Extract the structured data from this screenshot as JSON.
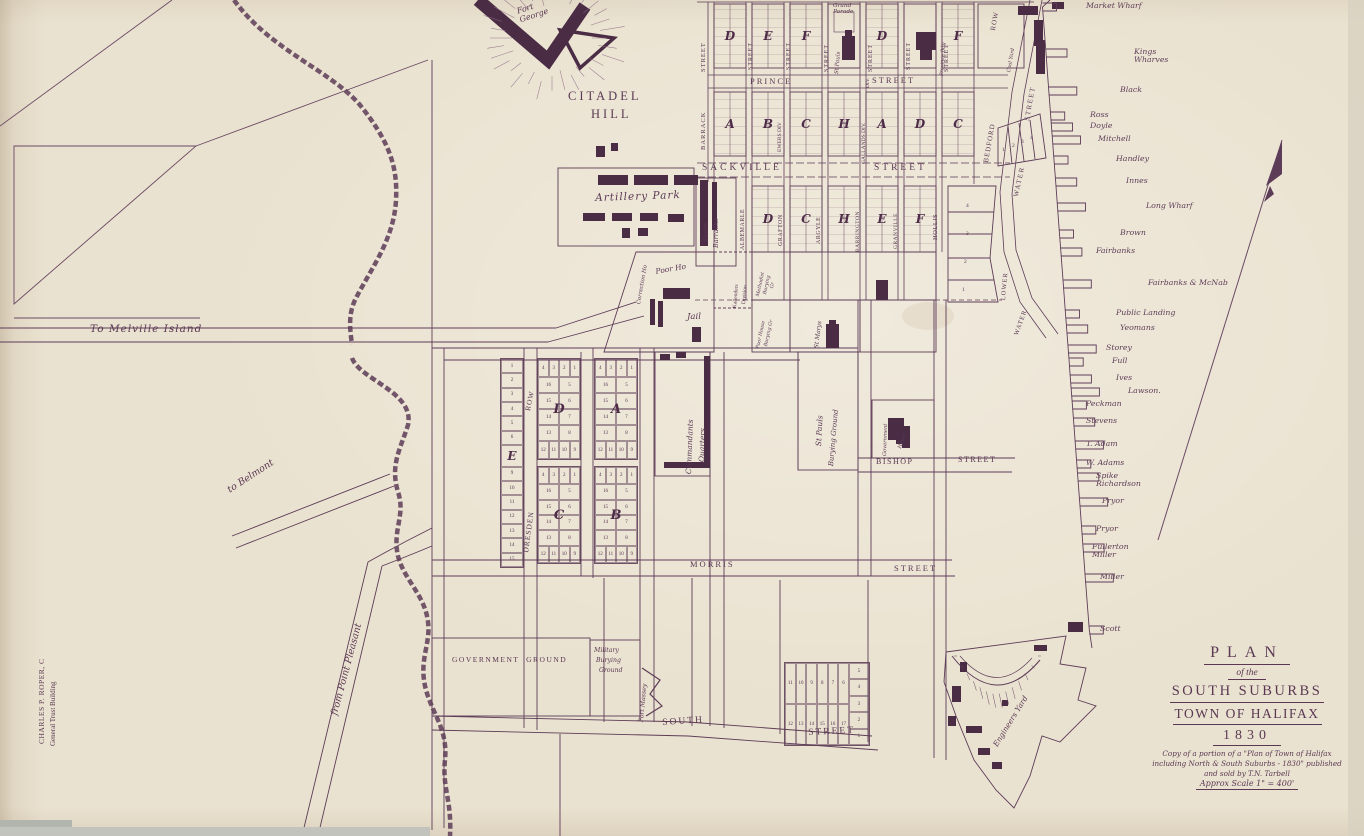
{
  "map_title": "Plan of the South Suburbs Town of Halifax 1830",
  "ink_color": "#5a3853",
  "paper_color": "#eae2d0",
  "dark_building_color": "#4a2c45",
  "title_block": {
    "plan": "PLAN",
    "of_the": "of the",
    "suburbs": "SOUTH SUBURBS",
    "town": "TOWN OF HALIFAX",
    "year": "1830",
    "note1": "Copy of a portion of a \"Plan of Town of Halifax",
    "note2": "including North & South Suburbs - 1830\" published",
    "note3": "and sold by T.N. Tarbell",
    "scale": "Approx Scale 1\" = 400'"
  },
  "labels": [
    {
      "n": "fort-george",
      "t": "Fort\nGeorge",
      "x": 516,
      "y": 8,
      "r": -18,
      "s": 8,
      "c": "h"
    },
    {
      "n": "citadel",
      "t": "CITADEL",
      "x": 568,
      "y": 90,
      "s": 12.5,
      "ls": 3,
      "c": "c"
    },
    {
      "n": "citadel-hill",
      "t": "HILL",
      "x": 591,
      "y": 108,
      "s": 12.5,
      "ls": 3,
      "c": "c"
    },
    {
      "n": "to-melville-island",
      "t": "To Melville Island",
      "x": 90,
      "y": 324,
      "s": 10.5,
      "ls": 1,
      "c": "h"
    },
    {
      "n": "to-belmont",
      "t": "to Belmont",
      "x": 226,
      "y": 487,
      "r": -33,
      "s": 9.5,
      "c": "h"
    },
    {
      "n": "from-point-pleasant",
      "t": "from Point Pleasant",
      "x": 330,
      "y": 714,
      "r": -75,
      "s": 9.5,
      "c": "h"
    },
    {
      "n": "credit-line-1",
      "t": "CHARLES P. ROPER, C",
      "x": 38,
      "y": 744,
      "r": -90,
      "s": 7.5,
      "ls": 0.5,
      "c": "p"
    },
    {
      "n": "credit-line-2",
      "t": "General Trust Building",
      "x": 50,
      "y": 746,
      "r": -90,
      "s": 7,
      "c": "p"
    },
    {
      "n": "barrack-street-name",
      "t": "BARRACK",
      "x": 700,
      "y": 150,
      "r": -90,
      "s": 6.5,
      "ls": 1,
      "c": "p"
    },
    {
      "n": "barrack-street-word",
      "t": "STREET",
      "x": 700,
      "y": 72,
      "r": -90,
      "s": 6.5,
      "ls": 1,
      "c": "p"
    },
    {
      "n": "street-v-2",
      "t": "STREET",
      "x": 748,
      "y": 70,
      "r": -90,
      "s": 6,
      "ls": 1,
      "c": "p"
    },
    {
      "n": "street-v-3",
      "t": "STREET",
      "x": 786,
      "y": 70,
      "r": -90,
      "s": 6,
      "ls": 1,
      "c": "p"
    },
    {
      "n": "street-v-4",
      "t": "STREET",
      "x": 824,
      "y": 72,
      "r": -90,
      "s": 6,
      "ls": 1,
      "c": "p"
    },
    {
      "n": "street-v-5",
      "t": "STREET",
      "x": 868,
      "y": 72,
      "r": -90,
      "s": 6,
      "ls": 1,
      "c": "p"
    },
    {
      "n": "street-v-6",
      "t": "STREET",
      "x": 906,
      "y": 70,
      "r": -90,
      "s": 6,
      "ls": 1,
      "c": "p"
    },
    {
      "n": "street-v-7",
      "t": "STREET",
      "x": 944,
      "y": 72,
      "r": -90,
      "s": 6,
      "ls": 1,
      "c": "p"
    },
    {
      "n": "bedford-row-word",
      "t": "ROW",
      "x": 990,
      "y": 30,
      "r": -80,
      "s": 7,
      "ls": 1,
      "c": "p"
    },
    {
      "n": "bedford-row-name",
      "t": "BEDFORD",
      "x": 983,
      "y": 162,
      "r": -80,
      "s": 7,
      "ls": 1,
      "c": "p"
    },
    {
      "n": "prince-street-name",
      "t": "PRINCE",
      "x": 750,
      "y": 77,
      "s": 8.5,
      "ls": 2,
      "c": "c"
    },
    {
      "n": "prince-street-word",
      "t": "STREET",
      "x": 872,
      "y": 76,
      "s": 8.5,
      "ls": 2,
      "c": "c"
    },
    {
      "n": "ewers-div",
      "t": "EWERS DIV",
      "x": 778,
      "y": 152,
      "r": -90,
      "s": 5.5,
      "c": "p"
    },
    {
      "n": "gallands-div",
      "t": "GALLANDS DIV.",
      "x": 862,
      "y": 164,
      "r": -90,
      "s": 5.5,
      "c": "p"
    },
    {
      "n": "div-label",
      "t": "DIV.",
      "x": 866,
      "y": 88,
      "r": -90,
      "s": 5.5,
      "c": "p"
    },
    {
      "n": "grand-parade",
      "t": "Grand\nParade",
      "x": 833,
      "y": 3,
      "s": 5.8,
      "c": "h"
    },
    {
      "n": "st-pauls-church",
      "t": "St Pauls",
      "x": 835,
      "y": 74,
      "r": -85,
      "s": 5.5,
      "c": "h"
    },
    {
      "n": "province-building",
      "t": "Province Bdg",
      "x": 940,
      "y": 76,
      "r": -87,
      "s": 5,
      "c": "h"
    },
    {
      "n": "coal-yard",
      "t": "Coal Yard",
      "x": 1007,
      "y": 72,
      "r": -80,
      "s": 5,
      "c": "h"
    },
    {
      "n": "sackville-street-name",
      "t": "SACKVILLE",
      "x": 702,
      "y": 163,
      "s": 9.5,
      "ls": 3,
      "c": "c"
    },
    {
      "n": "sackville-street-word",
      "t": "STREET",
      "x": 874,
      "y": 163,
      "s": 9.5,
      "ls": 3,
      "c": "c"
    },
    {
      "n": "albemarle-street",
      "t": "ALBEMARLE",
      "x": 740,
      "y": 250,
      "r": -90,
      "s": 6,
      "ls": 0.5,
      "c": "p"
    },
    {
      "n": "grafton-street",
      "t": "GRAFTON",
      "x": 778,
      "y": 246,
      "r": -90,
      "s": 6,
      "ls": 0.5,
      "c": "p"
    },
    {
      "n": "argyle-street",
      "t": "ARGYLE",
      "x": 816,
      "y": 244,
      "r": -90,
      "s": 6,
      "ls": 0.5,
      "c": "p"
    },
    {
      "n": "barrington-street",
      "t": "BARRINGTON",
      "x": 856,
      "y": 252,
      "r": -90,
      "s": 5.5,
      "ls": 0.5,
      "c": "p"
    },
    {
      "n": "granville-street",
      "t": "GRANVILLE",
      "x": 894,
      "y": 249,
      "r": -90,
      "s": 5.5,
      "ls": 0.5,
      "c": "p"
    },
    {
      "n": "hollis-street",
      "t": "HOLLIS",
      "x": 932,
      "y": 240,
      "r": -90,
      "s": 6.5,
      "ls": 0.5,
      "c": "p"
    },
    {
      "n": "water-street-name",
      "t": "WATER",
      "x": 1013,
      "y": 196,
      "r": -78,
      "s": 7,
      "ls": 1.5,
      "c": "p"
    },
    {
      "n": "water-street-word",
      "t": "STREET",
      "x": 1024,
      "y": 120,
      "r": -80,
      "s": 7,
      "ls": 1.5,
      "c": "p"
    },
    {
      "n": "lower-water-1",
      "t": "LOWER",
      "x": 1000,
      "y": 300,
      "r": -85,
      "s": 6.5,
      "ls": 1,
      "c": "p"
    },
    {
      "n": "lower-water-2",
      "t": "WATER",
      "x": 1013,
      "y": 334,
      "r": -70,
      "s": 6.5,
      "ls": 1,
      "c": "p"
    },
    {
      "n": "south-barracks-1",
      "t": "South",
      "x": 703,
      "y": 242,
      "r": -90,
      "s": 6.5,
      "c": "h"
    },
    {
      "n": "south-barracks-2",
      "t": "Barracks",
      "x": 713,
      "y": 248,
      "r": -90,
      "s": 6.5,
      "c": "h"
    },
    {
      "n": "artillery-park",
      "t": "Artillery Park",
      "x": 595,
      "y": 193,
      "r": -2,
      "s": 10.5,
      "ls": 1,
      "c": "h"
    },
    {
      "n": "correction-house",
      "t": "Correction Ho",
      "x": 637,
      "y": 304,
      "r": -80,
      "s": 5.5,
      "c": "h"
    },
    {
      "n": "poor-house",
      "t": "Poor Ho",
      "x": 655,
      "y": 268,
      "r": -10,
      "s": 7.5,
      "c": "h"
    },
    {
      "n": "jail",
      "t": "Jail",
      "x": 687,
      "y": 313,
      "s": 8.5,
      "c": "h"
    },
    {
      "n": "kallenders-division-1",
      "t": "Kallenders",
      "x": 733,
      "y": 308,
      "r": -85,
      "s": 5.5,
      "c": "p"
    },
    {
      "n": "kallenders-division-2",
      "t": "Division",
      "x": 742,
      "y": 304,
      "r": -85,
      "s": 5.5,
      "c": "p"
    },
    {
      "n": "methodist-burying-1",
      "t": "Methodist",
      "x": 756,
      "y": 296,
      "r": -78,
      "s": 4.8,
      "c": "h"
    },
    {
      "n": "methodist-burying-2",
      "t": "Burying",
      "x": 763,
      "y": 294,
      "r": -78,
      "s": 4.8,
      "c": "h"
    },
    {
      "n": "methodist-burying-3",
      "t": "Gr",
      "x": 770,
      "y": 288,
      "r": -78,
      "s": 4.8,
      "c": "h"
    },
    {
      "n": "poor-house-burying-1",
      "t": "Poor House",
      "x": 756,
      "y": 348,
      "r": -78,
      "s": 4.8,
      "c": "h"
    },
    {
      "n": "poor-house-burying-2",
      "t": "Burying Gr",
      "x": 764,
      "y": 346,
      "r": -78,
      "s": 4.8,
      "c": "h"
    },
    {
      "n": "st-marys",
      "t": "St Marys",
      "x": 814,
      "y": 348,
      "r": -83,
      "s": 6,
      "c": "h"
    },
    {
      "n": "dresden-row-word",
      "t": "ROW",
      "x": 524,
      "y": 410,
      "r": -78,
      "s": 7.5,
      "ls": 1,
      "c": "p"
    },
    {
      "n": "dresden-row-name",
      "t": "DRESDEN",
      "x": 522,
      "y": 552,
      "r": -82,
      "s": 7.5,
      "ls": 1,
      "c": "p"
    },
    {
      "n": "commandants-quarters-1",
      "t": "Commandants",
      "x": 685,
      "y": 474,
      "r": -88,
      "s": 7.5,
      "c": "h"
    },
    {
      "n": "commandants-quarters-2",
      "t": "Quarters",
      "x": 698,
      "y": 462,
      "r": -88,
      "s": 7.5,
      "c": "h"
    },
    {
      "n": "st-pauls-burying-1",
      "t": "St Pauls",
      "x": 815,
      "y": 446,
      "r": -87,
      "s": 7.5,
      "c": "h"
    },
    {
      "n": "st-pauls-burying-2",
      "t": "Burying Ground",
      "x": 828,
      "y": 466,
      "r": -85,
      "s": 7,
      "c": "h"
    },
    {
      "n": "government-house-1",
      "t": "Government",
      "x": 883,
      "y": 456,
      "r": -88,
      "s": 5.2,
      "c": "h"
    },
    {
      "n": "government-house-2",
      "t": "House",
      "x": 898,
      "y": 448,
      "r": -72,
      "s": 5.2,
      "c": "h"
    },
    {
      "n": "bishop-street-name",
      "t": "BISHOP",
      "x": 876,
      "y": 458,
      "s": 8,
      "ls": 1.5,
      "c": "c"
    },
    {
      "n": "bishop-street-word",
      "t": "STREET",
      "x": 958,
      "y": 456,
      "s": 8,
      "ls": 1.5,
      "c": "c"
    },
    {
      "n": "morris-street-name",
      "t": "MORRIS",
      "x": 690,
      "y": 560,
      "s": 8.5,
      "ls": 2,
      "c": "c"
    },
    {
      "n": "morris-street-word",
      "t": "STREET",
      "x": 894,
      "y": 564,
      "s": 8.5,
      "ls": 2,
      "c": "c"
    },
    {
      "n": "government-ground",
      "t": "GOVERNMENT  GROUND",
      "x": 452,
      "y": 656,
      "s": 7.5,
      "ls": 1.5,
      "c": "c"
    },
    {
      "n": "military-burying-1",
      "t": "Military",
      "x": 594,
      "y": 648,
      "s": 6.2,
      "c": "h"
    },
    {
      "n": "military-burying-2",
      "t": "Burying",
      "x": 596,
      "y": 658,
      "s": 6.2,
      "c": "h"
    },
    {
      "n": "military-burying-3",
      "t": "Ground",
      "x": 599,
      "y": 668,
      "s": 6.2,
      "c": "h"
    },
    {
      "n": "fort-massey",
      "t": "Fort Massey",
      "x": 639,
      "y": 722,
      "r": -85,
      "s": 6.2,
      "c": "h"
    },
    {
      "n": "south-street-name",
      "t": "SOUTH",
      "x": 662,
      "y": 718,
      "r": -4,
      "s": 9.5,
      "ls": 2,
      "c": "c"
    },
    {
      "n": "south-street-word",
      "t": "STREET",
      "x": 808,
      "y": 728,
      "r": -3,
      "s": 9.5,
      "ls": 2,
      "c": "c"
    },
    {
      "n": "engineers-yard",
      "t": "Engineers Yard",
      "x": 992,
      "y": 744,
      "r": -58,
      "s": 7.5,
      "c": "h"
    },
    {
      "n": "hollis-lot-4",
      "t": "4",
      "x": 966,
      "y": 204,
      "s": 5.5,
      "c": "n"
    },
    {
      "n": "hollis-lot-3",
      "t": "3",
      "x": 966,
      "y": 232,
      "s": 5.5,
      "c": "n"
    },
    {
      "n": "hollis-lot-2",
      "t": "2",
      "x": 964,
      "y": 260,
      "s": 5.5,
      "c": "n"
    },
    {
      "n": "hollis-lot-1",
      "t": "1",
      "x": 962,
      "y": 288,
      "s": 5.5,
      "c": "n"
    },
    {
      "n": "bedford-lot-1",
      "t": "1",
      "x": 1002,
      "y": 148,
      "s": 5.5,
      "c": "n"
    },
    {
      "n": "bedford-lot-2",
      "t": "2",
      "x": 1012,
      "y": 144,
      "s": 5.5,
      "c": "n"
    },
    {
      "n": "bedford-lot-3",
      "t": "3",
      "x": 1021,
      "y": 140,
      "s": 5.5,
      "c": "n"
    },
    {
      "n": "bedford-lot-4",
      "t": "4",
      "x": 1030,
      "y": 136,
      "s": 5.5,
      "c": "n"
    }
  ],
  "wharves": [
    {
      "t": "Market Wharf",
      "x": 1086,
      "y": 2
    },
    {
      "t": "Kings\nWharves",
      "x": 1134,
      "y": 48
    },
    {
      "t": "Black",
      "x": 1120,
      "y": 86
    },
    {
      "t": "Ross",
      "x": 1090,
      "y": 111
    },
    {
      "t": "Doyle",
      "x": 1090,
      "y": 122
    },
    {
      "t": "Mitchell",
      "x": 1098,
      "y": 135
    },
    {
      "t": "Handley",
      "x": 1116,
      "y": 155
    },
    {
      "t": "Innes",
      "x": 1126,
      "y": 177
    },
    {
      "t": "Long Wharf",
      "x": 1146,
      "y": 202
    },
    {
      "t": "Brown",
      "x": 1120,
      "y": 229
    },
    {
      "t": "Fairbanks",
      "x": 1096,
      "y": 247
    },
    {
      "t": "Fairbanks & McNab",
      "x": 1148,
      "y": 279
    },
    {
      "t": "Public Landing",
      "x": 1116,
      "y": 309
    },
    {
      "t": "Yeomans",
      "x": 1120,
      "y": 324
    },
    {
      "t": "Storey",
      "x": 1106,
      "y": 344
    },
    {
      "t": "Full",
      "x": 1112,
      "y": 357
    },
    {
      "t": "Ives",
      "x": 1116,
      "y": 374
    },
    {
      "t": "Lawson.",
      "x": 1128,
      "y": 387
    },
    {
      "t": "Peckman",
      "x": 1086,
      "y": 400
    },
    {
      "t": "Stevens",
      "x": 1086,
      "y": 417
    },
    {
      "t": "T. Adam",
      "x": 1086,
      "y": 440
    },
    {
      "t": "W. Adams",
      "x": 1086,
      "y": 459
    },
    {
      "t": "Spike\nRichardson",
      "x": 1096,
      "y": 472
    },
    {
      "t": "Pryor",
      "x": 1102,
      "y": 497
    },
    {
      "t": "Pryor",
      "x": 1096,
      "y": 525
    },
    {
      "t": "Fullerton\nMiller",
      "x": 1092,
      "y": 543
    },
    {
      "t": "Miller",
      "x": 1100,
      "y": 573
    },
    {
      "t": "Scott",
      "x": 1100,
      "y": 625
    }
  ],
  "grid_blocks": [
    {
      "l": "D",
      "x": 714,
      "y": 4,
      "w": 32,
      "h": 64
    },
    {
      "l": "E",
      "x": 752,
      "y": 4,
      "w": 32,
      "h": 64
    },
    {
      "l": "F",
      "x": 790,
      "y": 4,
      "w": 32,
      "h": 64
    },
    {
      "l": "",
      "x": 828,
      "y": 4,
      "w": 32,
      "h": 64,
      "plain": 1
    },
    {
      "l": "D",
      "x": 866,
      "y": 4,
      "w": 32,
      "h": 64
    },
    {
      "l": "",
      "x": 904,
      "y": 4,
      "w": 32,
      "h": 64,
      "plain": 1
    },
    {
      "l": "F",
      "x": 942,
      "y": 4,
      "w": 32,
      "h": 64
    },
    {
      "l": "A",
      "x": 714,
      "y": 92,
      "w": 32,
      "h": 64
    },
    {
      "l": "B",
      "x": 752,
      "y": 92,
      "w": 32,
      "h": 64
    },
    {
      "l": "C",
      "x": 790,
      "y": 92,
      "w": 32,
      "h": 64
    },
    {
      "l": "H",
      "x": 828,
      "y": 92,
      "w": 32,
      "h": 64
    },
    {
      "l": "A",
      "x": 866,
      "y": 92,
      "w": 32,
      "h": 64
    },
    {
      "l": "D",
      "x": 904,
      "y": 92,
      "w": 32,
      "h": 64
    },
    {
      "l": "C",
      "x": 942,
      "y": 92,
      "w": 32,
      "h": 64
    },
    {
      "l": "D",
      "x": 752,
      "y": 186,
      "w": 32,
      "h": 66
    },
    {
      "l": "C",
      "x": 790,
      "y": 186,
      "w": 32,
      "h": 66
    },
    {
      "l": "H",
      "x": 828,
      "y": 186,
      "w": 32,
      "h": 66
    },
    {
      "l": "E",
      "x": 866,
      "y": 186,
      "w": 32,
      "h": 66
    },
    {
      "l": "F",
      "x": 904,
      "y": 186,
      "w": 32,
      "h": 66
    }
  ],
  "central_blocks": [
    {
      "letter": "D",
      "x": 537,
      "y": 358,
      "w": 44,
      "h": 102,
      "top": [
        4,
        3,
        2,
        1
      ],
      "left": [
        16,
        15,
        14,
        13
      ],
      "right": [
        5,
        6,
        7,
        8
      ],
      "bottom": [
        12,
        11,
        10,
        9
      ]
    },
    {
      "letter": "A",
      "x": 594,
      "y": 358,
      "w": 44,
      "h": 102,
      "top": [
        4,
        3,
        2,
        1
      ],
      "left": [
        16,
        15,
        14,
        13
      ],
      "right": [
        5,
        6,
        7,
        8
      ],
      "bottom": [
        12,
        11,
        10,
        9
      ]
    },
    {
      "letter": "C",
      "x": 537,
      "y": 466,
      "w": 44,
      "h": 98,
      "top": [
        4,
        3,
        2,
        1
      ],
      "left": [
        16,
        15,
        14,
        13
      ],
      "right": [
        5,
        6,
        7,
        8
      ],
      "bottom": [
        12,
        11,
        10,
        9
      ]
    },
    {
      "letter": "B",
      "x": 594,
      "y": 466,
      "w": 44,
      "h": 98,
      "top": [
        4,
        3,
        2,
        1
      ],
      "left": [
        16,
        15,
        14,
        13
      ],
      "right": [
        5,
        6,
        7,
        8
      ],
      "bottom": [
        12,
        11,
        10,
        9
      ]
    }
  ],
  "e_block": {
    "letter": "E",
    "x": 500,
    "y": 358,
    "w": 24,
    "h": 210,
    "top": [
      1,
      2,
      3,
      4,
      5,
      6
    ],
    "bottom": [
      9,
      10,
      11,
      12,
      13,
      14,
      15
    ]
  },
  "bottom_grid": {
    "x": 784,
    "y": 662,
    "w": 86,
    "h": 84,
    "row1": [
      11,
      10,
      9,
      8,
      7,
      6
    ],
    "row2": [
      12,
      13,
      14,
      15,
      16,
      17
    ],
    "side": [
      5,
      4,
      3,
      2,
      1
    ]
  }
}
